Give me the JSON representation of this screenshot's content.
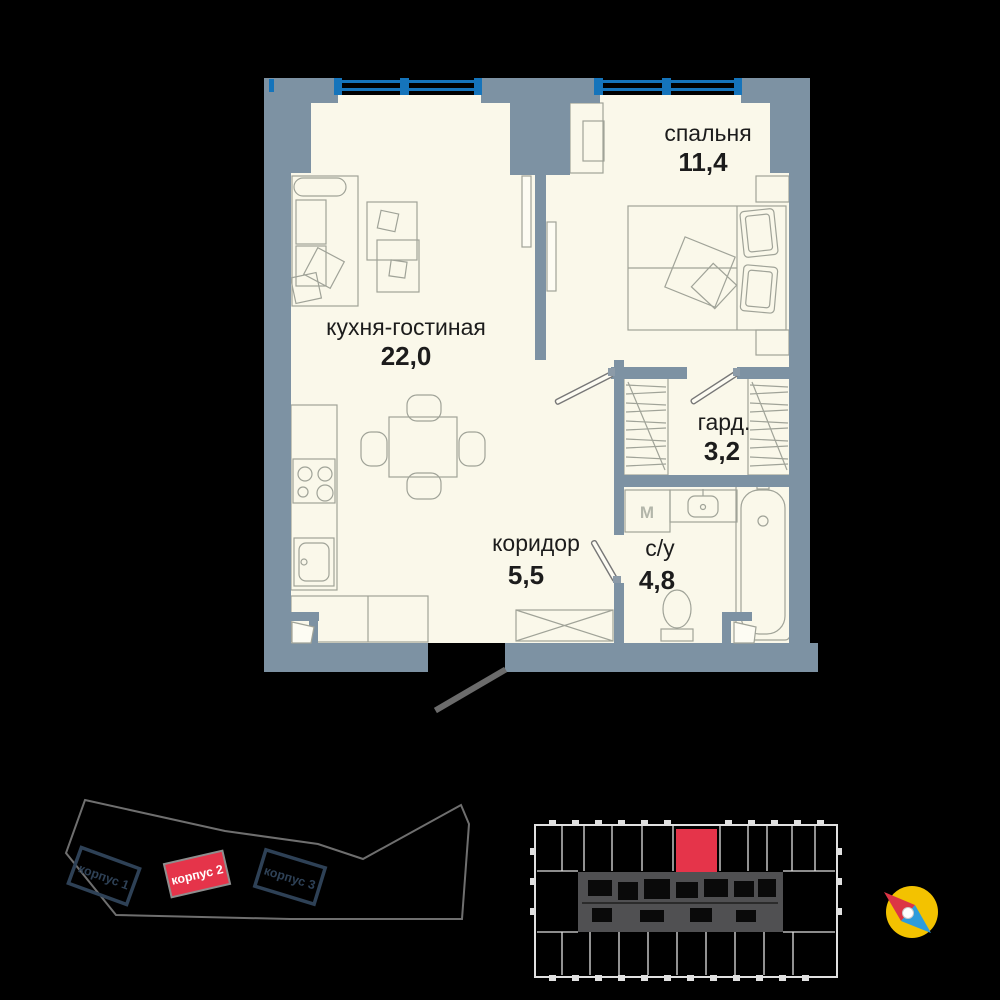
{
  "colors": {
    "background": "#000000",
    "floor": "#FAF8EA",
    "wall": "#7D92A3",
    "window_frame": "#1574BB",
    "furniture_line": "#A0A398",
    "label_text": "#1C1C1C",
    "highlight_red": "#E5344A",
    "site_outline": "#6F6F6F",
    "building_outline": "#2E4156",
    "keyplan_line": "#E0E0E0",
    "keyplan_core": "#505052",
    "door_line": "#6B6B6B",
    "compass_yellow": "#F3C200",
    "compass_red": "#DC3545",
    "compass_blue": "#2D9CDB"
  },
  "floor_plan": {
    "rooms": [
      {
        "id": "bedroom",
        "name": "спальня",
        "area": "11,4"
      },
      {
        "id": "kitchen-living",
        "name": "кухня-гостиная",
        "area": "22,0"
      },
      {
        "id": "wardrobe",
        "name": "гард.",
        "area": "3,2"
      },
      {
        "id": "corridor",
        "name": "коридор",
        "area": "5,5"
      },
      {
        "id": "bathroom",
        "name": "с/у",
        "area": "4,8"
      }
    ],
    "washer_label": "М"
  },
  "site_plan": {
    "buildings": [
      {
        "label": "корпус 1",
        "highlighted": false
      },
      {
        "label": "корпус 2",
        "highlighted": true
      },
      {
        "label": "корпус 3",
        "highlighted": false
      }
    ]
  },
  "key_plan": {
    "selected_unit_color": "#E5344A"
  }
}
